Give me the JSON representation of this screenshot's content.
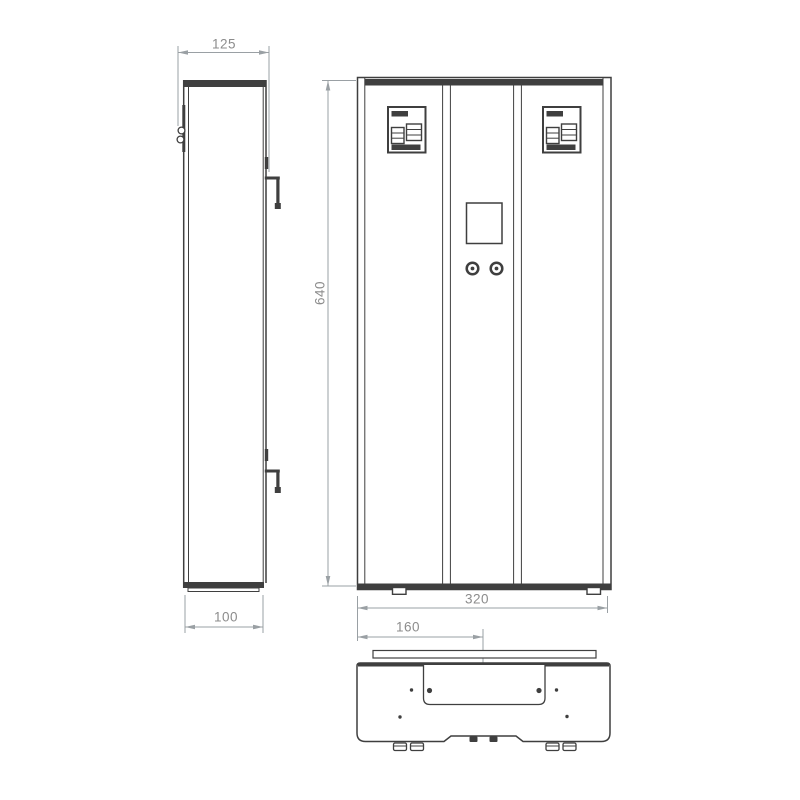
{
  "dimensions": {
    "depth_top": "125",
    "height": "640",
    "depth_bottom": "100",
    "width": "320",
    "half_width": "160"
  },
  "colors": {
    "background": "#ffffff",
    "line": "#3f3f3f",
    "dim_line": "#9aa0a4",
    "dim_text": "#8c8c8c"
  }
}
